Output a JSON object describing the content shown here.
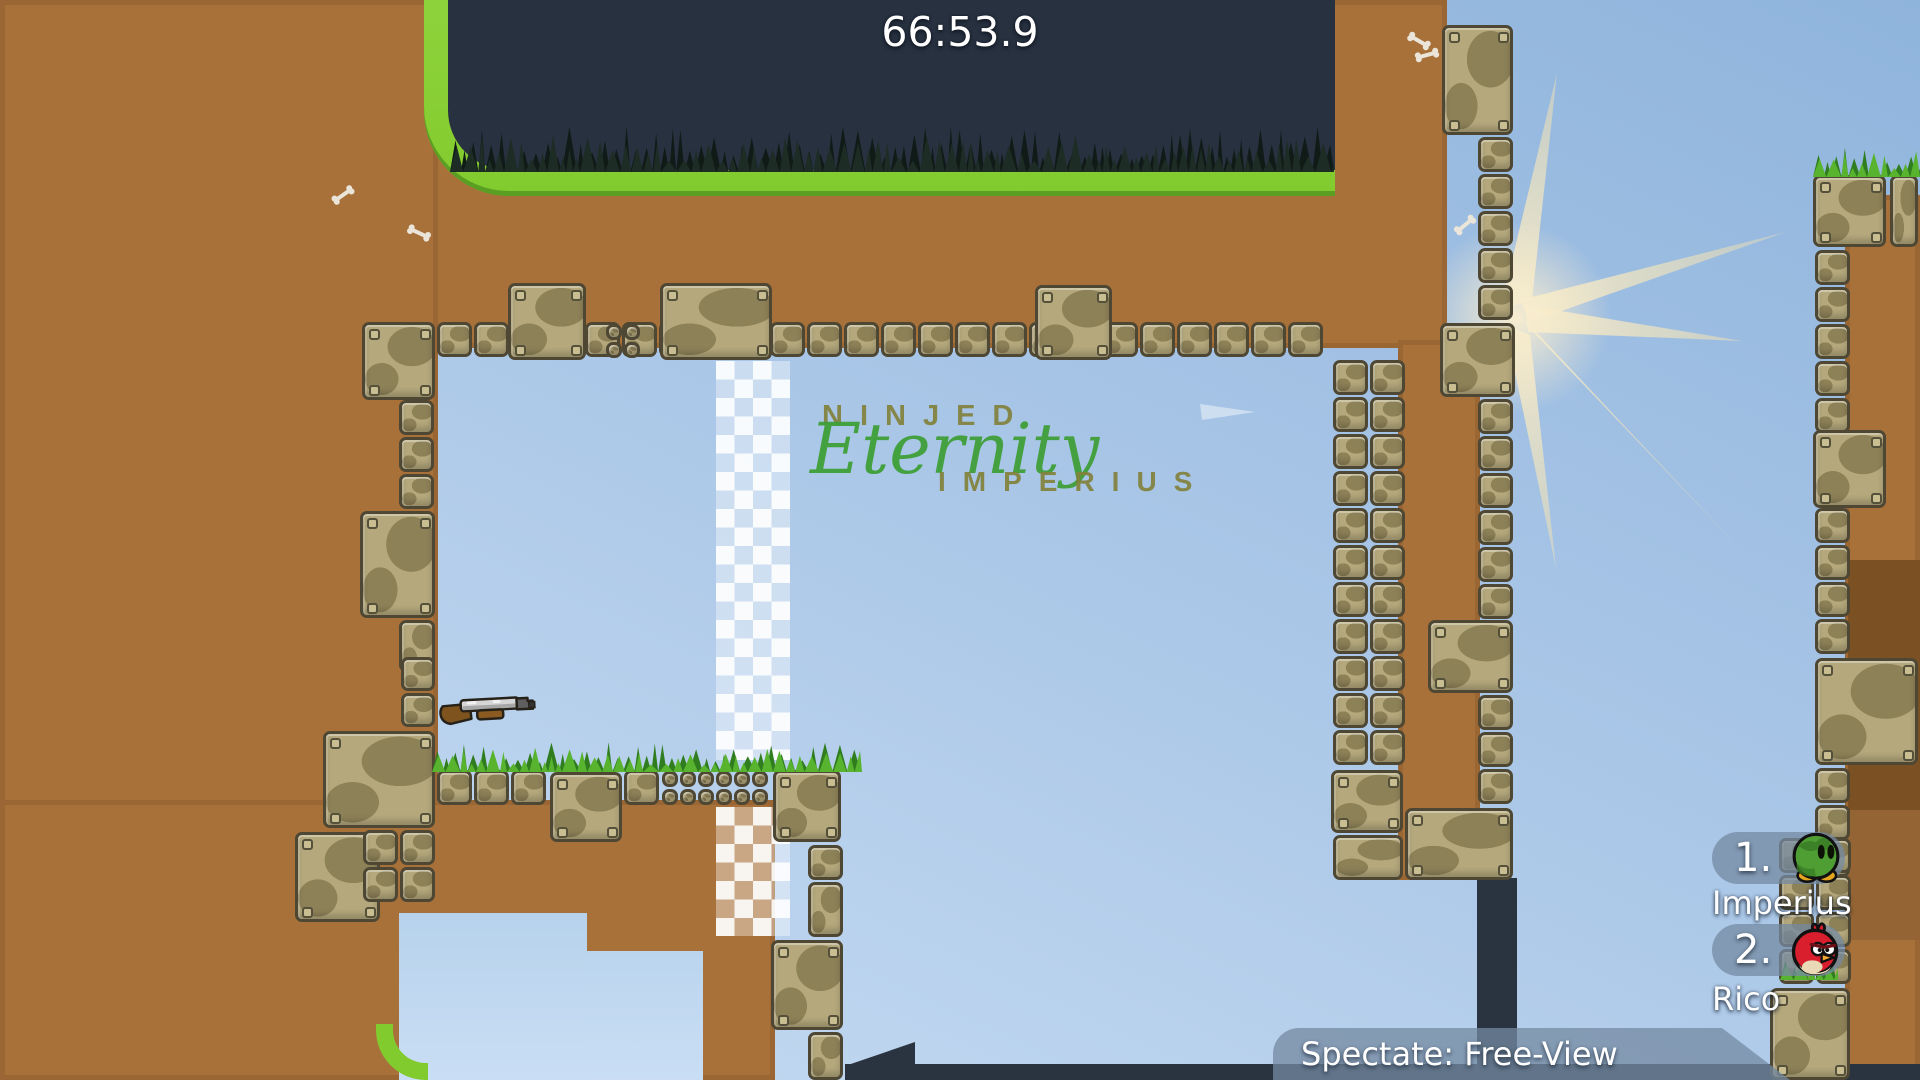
{
  "hud": {
    "timer": "66:53.9",
    "spectate_label": "Spectate: Free-View"
  },
  "map_texts": {
    "title_top": "NINJED",
    "title_main": "Eternity",
    "title_bottom": "IMPERIUS"
  },
  "leaderboard": [
    {
      "rank": "1.",
      "name": "Imperius",
      "avatar": "green-camo-tee"
    },
    {
      "rank": "2.",
      "name": "Rico",
      "avatar": "red-bird-tee"
    }
  ],
  "icons": {
    "pickup": "shotgun-pickup-icon",
    "background_light": "sunburst-icon",
    "decoration": "bone-icon"
  },
  "colors": {
    "sky_top": "#8fb4dc",
    "sky_bottom": "#cadef3",
    "dirt": "#a8713a",
    "dirt_dark": "#7b5124",
    "cave": "#273140",
    "cave_grass": "#1d2c25",
    "grass_bright": "#58b42e",
    "grass_dark": "#2f7d1e",
    "border_green": "#82cb2e",
    "stone": "#b4a87c",
    "stone_border": "#4e4733",
    "navy": "#2a3441",
    "checker_white": "rgba(255,255,255,0.92)",
    "hud_panel": "rgba(116,138,162,0.75)",
    "text_white": "#ffffff",
    "map_text_olive": "#82823c",
    "map_text_green": "#3f9f38",
    "sun": "#f6ead0",
    "tee_green": "#4f9e33",
    "tee_red": "#d91f2e"
  }
}
